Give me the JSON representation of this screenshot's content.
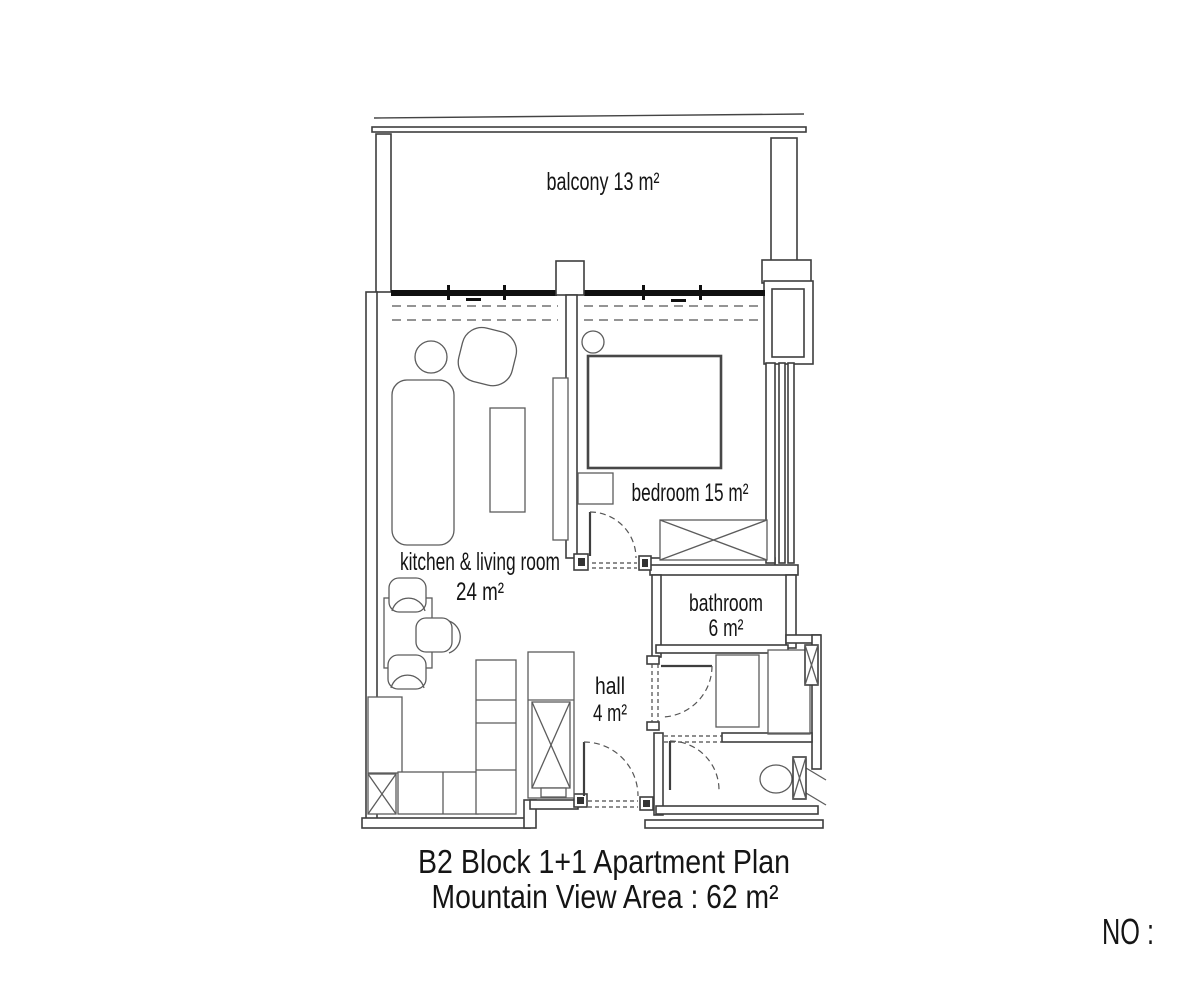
{
  "plan": {
    "balcony_label": "balcony 13 m²",
    "kitchen_label": "kitchen & living room",
    "kitchen_area": "24 m²",
    "bedroom_label": "bedroom 15 m²",
    "bathroom_label": "bathroom",
    "bathroom_area": "6 m²",
    "hall_label": "hall",
    "hall_area": "4 m²"
  },
  "footer": {
    "title_line1": "B2 Block 1+1 Apartment Plan",
    "title_line2": "Mountain View Area : 62 m²",
    "no_label": "NO :"
  },
  "colors": {
    "wall": "#3e3e3e",
    "window": "#101010",
    "furniture": "#5c5c5c",
    "text": "#151515",
    "background": "#ffffff"
  }
}
